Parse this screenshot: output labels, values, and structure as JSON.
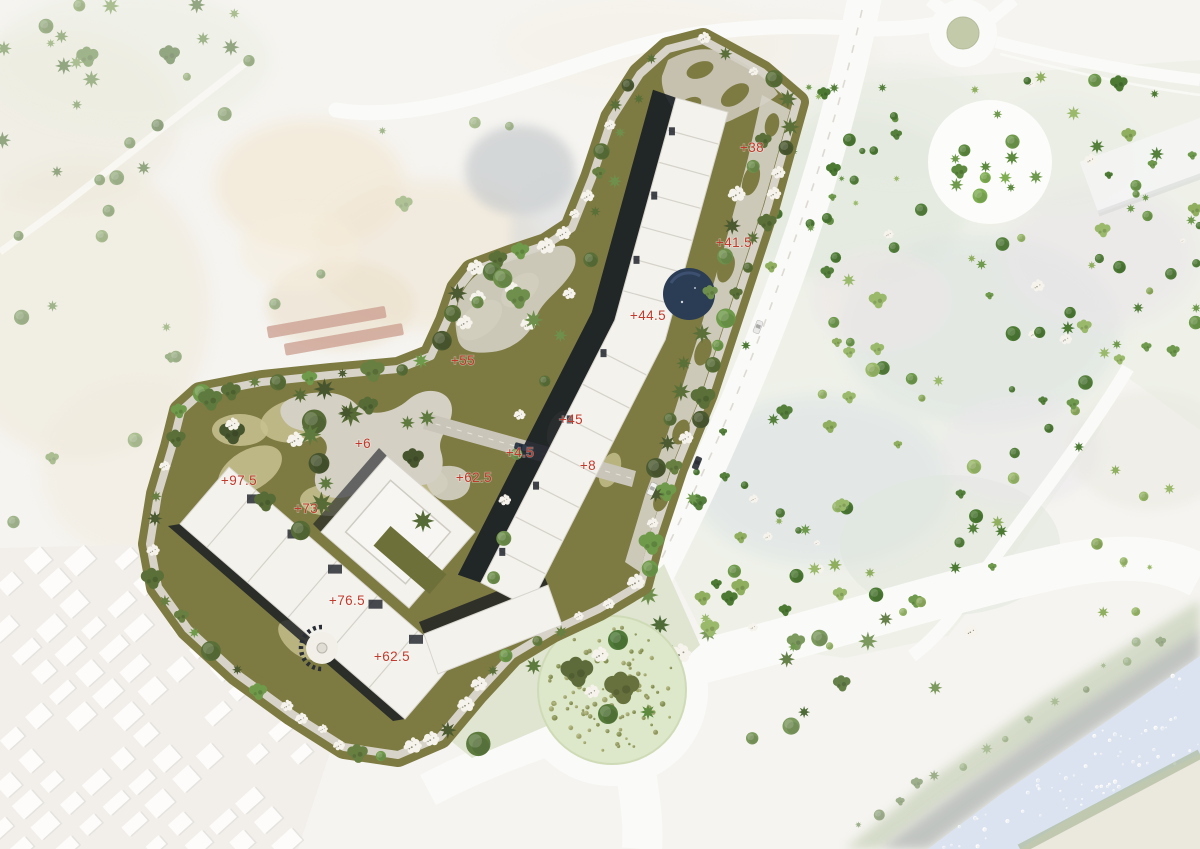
{
  "scene": {
    "kind": "architectural masterplan site plan over faded aerial photo",
    "elevation_labels": [
      {
        "text": "+38",
        "x": 752,
        "y": 152
      },
      {
        "text": "+41.5",
        "x": 734,
        "y": 247
      },
      {
        "text": "+44.5",
        "x": 648,
        "y": 320
      },
      {
        "text": "+55",
        "x": 463,
        "y": 365
      },
      {
        "text": "+45",
        "x": 571,
        "y": 424
      },
      {
        "text": "+6",
        "x": 363,
        "y": 448
      },
      {
        "text": "+4.5",
        "x": 520,
        "y": 457
      },
      {
        "text": "+62.5",
        "x": 474,
        "y": 482
      },
      {
        "text": "+8",
        "x": 588,
        "y": 470
      },
      {
        "text": "+97.5",
        "x": 239,
        "y": 485
      },
      {
        "text": "+73",
        "x": 306,
        "y": 513
      },
      {
        "text": "+76.5",
        "x": 347,
        "y": 605
      },
      {
        "text": "+62.5",
        "x": 392,
        "y": 661
      }
    ],
    "colors": {
      "label_red": "#c23a2b",
      "site_olive": "#7d7a42",
      "site_khaki": "#c8c290",
      "path_gray": "#d7d3c8",
      "building_white": "#f3f2ed",
      "shadow_dark": "#151a22",
      "pool_blue": "#2b3c55",
      "road_white": "#fafaf8",
      "roundabout_green": "#c3caa9",
      "south_circle_green": "#dde7c9",
      "river_blue": "#c7d4e9",
      "tree_white": "#f6f3ec"
    },
    "cars": [
      {
        "x": 758,
        "y": 327,
        "angle": 112,
        "color": "#e9e9e7"
      },
      {
        "x": 697,
        "y": 463,
        "angle": 112,
        "color": "#3c4148"
      },
      {
        "x": 652,
        "y": 489,
        "angle": 114,
        "color": "#f2f2f0"
      },
      {
        "x": 521,
        "y": 447,
        "angle": 15,
        "color": "#2f3a4a"
      }
    ],
    "south_circle": {
      "c": [
        612,
        690
      ],
      "r": 74,
      "trees": [
        {
          "x": 577,
          "y": 672,
          "s": 13,
          "t": "o",
          "c": "#5d6b3a"
        },
        {
          "x": 622,
          "y": 688,
          "s": 14,
          "t": "o",
          "c": "#66713d"
        },
        {
          "x": 618,
          "y": 640,
          "s": 10,
          "t": "r",
          "c": "#4f7a38"
        },
        {
          "x": 600,
          "y": 655,
          "s": 9,
          "t": "w",
          "c": "#f6f3ec"
        },
        {
          "x": 592,
          "y": 692,
          "s": 8,
          "t": "w",
          "c": "#f6f3ec"
        },
        {
          "x": 608,
          "y": 714,
          "s": 10,
          "t": "r",
          "c": "#567a3a"
        },
        {
          "x": 648,
          "y": 712,
          "s": 8,
          "t": "s",
          "c": "#5d8a3e"
        }
      ]
    },
    "site_outline": [
      [
        703,
        40
      ],
      [
        762,
        72
      ],
      [
        797,
        102
      ],
      [
        768,
        206
      ],
      [
        737,
        300
      ],
      [
        706,
        394
      ],
      [
        676,
        468
      ],
      [
        654,
        534
      ],
      [
        641,
        584
      ],
      [
        599,
        609
      ],
      [
        552,
        631
      ],
      [
        512,
        655
      ],
      [
        476,
        694
      ],
      [
        440,
        737
      ],
      [
        398,
        755
      ],
      [
        344,
        747
      ],
      [
        292,
        714
      ],
      [
        237,
        674
      ],
      [
        188,
        629
      ],
      [
        158,
        587
      ],
      [
        150,
        544
      ],
      [
        158,
        494
      ],
      [
        172,
        447
      ],
      [
        181,
        411
      ],
      [
        200,
        394
      ],
      [
        262,
        382
      ],
      [
        330,
        375
      ],
      [
        398,
        369
      ],
      [
        431,
        356
      ],
      [
        447,
        321
      ],
      [
        458,
        289
      ],
      [
        472,
        271
      ],
      [
        510,
        257
      ],
      [
        546,
        245
      ],
      [
        572,
        228
      ],
      [
        592,
        178
      ],
      [
        612,
        118
      ],
      [
        640,
        74
      ],
      [
        668,
        49
      ]
    ],
    "scatter_regions": [
      {
        "group": "g-trees-faded",
        "type": "poly",
        "pts": [
          [
            0,
            0
          ],
          [
            258,
            0
          ],
          [
            266,
            96
          ],
          [
            168,
            172
          ],
          [
            58,
            196
          ],
          [
            0,
            172
          ]
        ],
        "count": 26,
        "smin": 4,
        "smax": 9,
        "palette": [
          "#6a8a48",
          "#57753c",
          "#7c9a55"
        ],
        "white_ratio": 0.05
      },
      {
        "group": "g-trees-faded",
        "type": "poly",
        "pts": [
          [
            0,
            200
          ],
          [
            148,
            212
          ],
          [
            190,
            330
          ],
          [
            158,
            520
          ],
          [
            40,
            556
          ],
          [
            0,
            540
          ]
        ],
        "count": 11,
        "smin": 4,
        "smax": 8,
        "palette": [
          "#6a8a48",
          "#7c9a55"
        ],
        "white_ratio": 0
      },
      {
        "group": "g-trees-faded",
        "type": "poly",
        "pts": [
          [
            252,
            100
          ],
          [
            556,
            122
          ],
          [
            598,
            298
          ],
          [
            422,
            378
          ],
          [
            262,
            328
          ]
        ],
        "count": 8,
        "smin": 4,
        "smax": 8,
        "palette": [
          "#6f8f4d",
          "#83a05c"
        ],
        "white_ratio": 0
      },
      {
        "group": "g-trees-faded",
        "type": "line",
        "pts": [
          [
            862,
            830
          ],
          [
            960,
            762
          ],
          [
            1060,
            700
          ],
          [
            1180,
            622
          ]
        ],
        "step": 26,
        "jitter": 8,
        "smin": 3,
        "smax": 6,
        "palette": [
          "#7d9a5e",
          "#66804a"
        ],
        "white_ratio": 0
      },
      {
        "group": "g-river-speckles",
        "type": "poly",
        "pts": [
          [
            928,
            849
          ],
          [
            1000,
            795
          ],
          [
            1090,
            733
          ],
          [
            1200,
            656
          ],
          [
            1200,
            754
          ],
          [
            1080,
            812
          ],
          [
            1020,
            849
          ]
        ],
        "count": 70,
        "smin": 0.8,
        "smax": 2.2,
        "palette": [
          "#eef3fa",
          "#ffffff"
        ],
        "white_ratio": 0,
        "sym": "r"
      },
      {
        "group": "g-trees-east",
        "type": "poly",
        "pts": [
          [
            782,
            88
          ],
          [
            1200,
            60
          ],
          [
            1200,
            430
          ],
          [
            1120,
            372
          ],
          [
            1100,
            430
          ],
          [
            1010,
            560
          ],
          [
            948,
            636
          ],
          [
            845,
            658
          ],
          [
            706,
            640
          ],
          [
            663,
            556
          ],
          [
            698,
            452
          ],
          [
            748,
            300
          ]
        ],
        "count": 150,
        "smin": 3,
        "smax": 7.5,
        "palette": [
          "#8fae5e",
          "#55803c",
          "#6f9a4d",
          "#9ab96a",
          "#4c7a33"
        ],
        "white_ratio": 0.1,
        "avoid": [
          [
            990,
            162,
            70
          ],
          [
            963,
            33,
            44
          ]
        ]
      },
      {
        "group": "g-trees-east",
        "type": "poly",
        "pts": [
          [
            1070,
            455
          ],
          [
            1200,
            438
          ],
          [
            1200,
            600
          ],
          [
            1082,
            628
          ]
        ],
        "count": 9,
        "smin": 3,
        "smax": 6,
        "palette": [
          "#8fae5e",
          "#9ab96a"
        ],
        "white_ratio": 0.1
      },
      {
        "group": "g-trees-east",
        "type": "poly",
        "pts": [
          [
            1098,
            118
          ],
          [
            1200,
            98
          ],
          [
            1200,
            222
          ],
          [
            1106,
            212
          ]
        ],
        "count": 6,
        "smin": 3.5,
        "smax": 6,
        "palette": [
          "#6f9a4d",
          "#8fae5e"
        ],
        "white_ratio": 0
      },
      {
        "group": "g-plaza-trees",
        "type": "dots",
        "c": [
          990,
          162
        ],
        "r": 50,
        "count": 13,
        "smin": 4.5,
        "smax": 8,
        "palette": [
          "#5d8a3e",
          "#6f9a4d",
          "#7fae52"
        ],
        "white_ratio": 0
      },
      {
        "group": "g-south-veg",
        "type": "poly",
        "pts": [
          [
            696,
            630
          ],
          [
            950,
            598
          ],
          [
            1008,
            640
          ],
          [
            955,
            700
          ],
          [
            852,
            722
          ],
          [
            756,
            742
          ],
          [
            700,
            702
          ]
        ],
        "count": 12,
        "smin": 6,
        "smax": 11,
        "palette": [
          "#4f6b38",
          "#66804a",
          "#7d9a5e"
        ],
        "white_ratio": 0.15
      },
      {
        "group": "g-outside-veg",
        "type": "poly",
        "pts": [
          [
            440,
            732
          ],
          [
            478,
            696
          ],
          [
            515,
            658
          ],
          [
            572,
            630
          ],
          [
            636,
            592
          ],
          [
            664,
            564
          ],
          [
            700,
            645
          ],
          [
            640,
            700
          ],
          [
            556,
            722
          ],
          [
            472,
            758
          ]
        ],
        "count": 10,
        "smin": 8,
        "smax": 14,
        "palette": [
          "#4f6b38",
          "#5d7a3f",
          "#6f904c"
        ],
        "white_ratio": 0.25
      },
      {
        "group": "g-site-trees",
        "type": "line",
        "pts": "SITE_OUTLINE",
        "step": 27,
        "jitter": 5,
        "smin": 5,
        "smax": 10,
        "palette": [
          "#4b5a30",
          "#5a7038",
          "#687f42",
          "#6f9a4a"
        ],
        "white_ratio": 0.28
      },
      {
        "group": "g-site-trees",
        "type": "poly",
        "pts": [
          [
            200,
            396
          ],
          [
            418,
            378
          ],
          [
            446,
            420
          ],
          [
            430,
            520
          ],
          [
            330,
            544
          ],
          [
            214,
            520
          ],
          [
            182,
            452
          ]
        ],
        "count": 20,
        "smin": 7,
        "smax": 13,
        "palette": [
          "#47552e",
          "#566b36",
          "#5f7a3e"
        ],
        "white_ratio": 0.15
      },
      {
        "group": "g-site-trees",
        "type": "poly",
        "pts": [
          [
            452,
            272
          ],
          [
            560,
            240
          ],
          [
            584,
            300
          ],
          [
            520,
            360
          ],
          [
            456,
            350
          ]
        ],
        "count": 9,
        "smin": 6,
        "smax": 10,
        "palette": [
          "#5d7a3f",
          "#6f904c"
        ],
        "white_ratio": 0.5
      },
      {
        "group": "g-site-trees",
        "type": "line",
        "pts": [
          [
            762,
            140
          ],
          [
            718,
            262
          ],
          [
            678,
            390
          ],
          [
            652,
            515
          ]
        ],
        "step": 33,
        "jitter": 7,
        "smin": 6,
        "smax": 10,
        "palette": [
          "#4b5a30",
          "#5a7038",
          "#6f904c"
        ],
        "white_ratio": 0.2
      },
      {
        "group": "g-site-trees",
        "type": "line",
        "pts": [
          [
            636,
            98
          ],
          [
            575,
            290
          ],
          [
            520,
            430
          ],
          [
            492,
            588
          ]
        ],
        "step": 40,
        "jitter": 6,
        "smin": 5,
        "smax": 8,
        "palette": [
          "#5a7038",
          "#6f904c"
        ],
        "white_ratio": 0.25
      },
      {
        "group": "g-south-circle-dots",
        "type": "dots",
        "c": [
          612,
          690
        ],
        "r": 64,
        "count": 95,
        "smin": 1.2,
        "smax": 2.8,
        "palette": [
          "#9aa163",
          "#aab072",
          "#8e9a58"
        ],
        "white_ratio": 0,
        "sym": "r"
      },
      {
        "group": "g-urban",
        "type": "grid",
        "origin": [
          -160,
          700
        ],
        "imin": 0,
        "imax": 15,
        "jmin": -1,
        "jmax": 15,
        "angle": -42,
        "cw": 34,
        "ch": 29,
        "bw": 23,
        "bh": 15,
        "skip": 0.18,
        "color": "#fcfbf8",
        "clip": [
          [
            0,
            548
          ],
          [
            334,
            540
          ],
          [
            350,
            692
          ],
          [
            298,
            849
          ],
          [
            0,
            849
          ]
        ]
      }
    ]
  }
}
